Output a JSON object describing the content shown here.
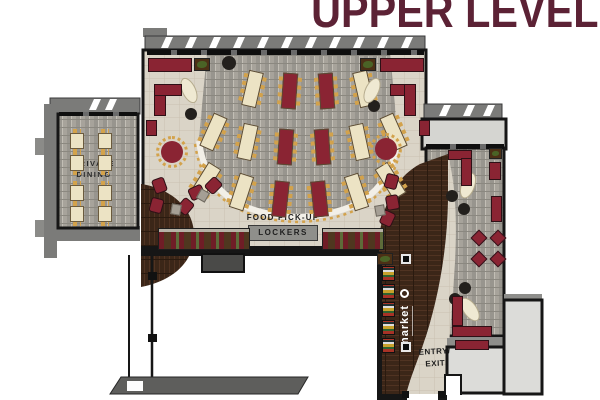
{
  "title": "UPPER LEVEL",
  "labels": {
    "private_dining_line1": "PRIVATE",
    "private_dining_line2": "DINING",
    "food_pickup": "FOOD PICK-UP",
    "lockers": "LOCKERS",
    "market": "market",
    "entry_line1": "ENTRY/",
    "entry_line2": "EXIT"
  },
  "colors": {
    "title": "#5c2235",
    "wall": "#161616",
    "roof": "#7b7b79",
    "canopy": "#d5d5d1",
    "stone": "#d9d3c6",
    "carpet": "#9b9890",
    "wood": "#3a2517",
    "cream": "#ece3c4",
    "table_maroon": "#8a2433",
    "booth_maroon": "#6f1d26",
    "gold": "#d3a24b",
    "locker_gray": "#8f8f8b"
  },
  "furniture": {
    "fan_tables": [
      {
        "x": 253,
        "y": 89,
        "rot": 13,
        "c": "cream"
      },
      {
        "x": 290,
        "y": 91,
        "rot": 4,
        "c": "maroon"
      },
      {
        "x": 327,
        "y": 91,
        "rot": -4,
        "c": "maroon"
      },
      {
        "x": 364,
        "y": 89,
        "rot": -13,
        "c": "cream"
      },
      {
        "x": 214,
        "y": 132,
        "rot": 24,
        "c": "cream"
      },
      {
        "x": 248,
        "y": 142,
        "rot": 12,
        "c": "cream"
      },
      {
        "x": 286,
        "y": 147,
        "rot": 4,
        "c": "maroon"
      },
      {
        "x": 323,
        "y": 147,
        "rot": -4,
        "c": "maroon"
      },
      {
        "x": 360,
        "y": 142,
        "rot": -12,
        "c": "cream"
      },
      {
        "x": 394,
        "y": 132,
        "rot": -24,
        "c": "cream"
      },
      {
        "x": 206,
        "y": 181,
        "rot": 32,
        "c": "cream"
      },
      {
        "x": 242,
        "y": 192,
        "rot": 18,
        "c": "cream"
      },
      {
        "x": 281,
        "y": 199,
        "rot": 6,
        "c": "maroon"
      },
      {
        "x": 320,
        "y": 199,
        "rot": -6,
        "c": "maroon"
      },
      {
        "x": 357,
        "y": 192,
        "rot": -18,
        "c": "cream"
      },
      {
        "x": 391,
        "y": 181,
        "rot": -32,
        "c": "cream"
      }
    ],
    "private_tables": [
      {
        "x": 70,
        "y": 133
      },
      {
        "x": 98,
        "y": 133
      },
      {
        "x": 70,
        "y": 155
      },
      {
        "x": 98,
        "y": 155
      },
      {
        "x": 70,
        "y": 185
      },
      {
        "x": 98,
        "y": 185
      },
      {
        "x": 70,
        "y": 206
      },
      {
        "x": 98,
        "y": 206
      }
    ],
    "columns": [
      {
        "x": 229,
        "y": 63,
        "r": 7
      },
      {
        "x": 191,
        "y": 114,
        "r": 6
      },
      {
        "x": 374,
        "y": 106,
        "r": 6
      },
      {
        "x": 452,
        "y": 196,
        "r": 6
      },
      {
        "x": 464,
        "y": 209,
        "r": 6
      },
      {
        "x": 465,
        "y": 288,
        "r": 6
      },
      {
        "x": 455,
        "y": 299,
        "r": 6
      }
    ],
    "ovals": [
      {
        "x": 189,
        "y": 91,
        "rot": -25
      },
      {
        "x": 372,
        "y": 91,
        "rot": 25
      },
      {
        "x": 468,
        "y": 186,
        "rot": 20
      },
      {
        "x": 470,
        "y": 310,
        "rot": -35
      }
    ],
    "round_tables": [
      {
        "x": 172,
        "y": 152
      },
      {
        "x": 386,
        "y": 149
      }
    ],
    "diamonds": [
      {
        "x": 479,
        "y": 238
      },
      {
        "x": 498,
        "y": 238
      },
      {
        "x": 479,
        "y": 259
      },
      {
        "x": 498,
        "y": 259
      }
    ],
    "lounges": [
      {
        "x": 160,
        "y": 186,
        "rot": -20
      },
      {
        "x": 157,
        "y": 206,
        "rot": 15
      },
      {
        "x": 186,
        "y": 207,
        "rot": 40
      },
      {
        "x": 197,
        "y": 193,
        "rot": 65
      },
      {
        "x": 214,
        "y": 186,
        "rot": 45
      },
      {
        "x": 392,
        "y": 182,
        "rot": 15
      },
      {
        "x": 393,
        "y": 203,
        "rot": -10
      },
      {
        "x": 388,
        "y": 219,
        "rot": 25
      }
    ],
    "side_tables": [
      {
        "x": 176,
        "y": 210,
        "rot": 10
      },
      {
        "x": 380,
        "y": 211,
        "rot": -10
      },
      {
        "x": 203,
        "y": 196,
        "rot": 30
      }
    ],
    "benches": [
      {
        "x": 148,
        "y": 58,
        "w": 44,
        "h": 14,
        "rot": 0
      },
      {
        "x": 380,
        "y": 58,
        "w": 44,
        "h": 14,
        "rot": 0
      },
      {
        "x": 154,
        "y": 84,
        "w": 12,
        "h": 32,
        "rot": 0
      },
      {
        "x": 154,
        "y": 84,
        "w": 28,
        "h": 12,
        "rot": 0
      },
      {
        "x": 390,
        "y": 84,
        "w": 26,
        "h": 12,
        "rot": 0
      },
      {
        "x": 404,
        "y": 84,
        "w": 12,
        "h": 32,
        "rot": 0
      },
      {
        "x": 146,
        "y": 120,
        "w": 11,
        "h": 16,
        "rot": 0
      },
      {
        "x": 419,
        "y": 120,
        "w": 11,
        "h": 16,
        "rot": 0
      },
      {
        "x": 448,
        "y": 150,
        "w": 24,
        "h": 10,
        "rot": 0
      },
      {
        "x": 461,
        "y": 158,
        "w": 11,
        "h": 28,
        "rot": 0
      },
      {
        "x": 489,
        "y": 162,
        "w": 12,
        "h": 18,
        "rot": 0
      },
      {
        "x": 491,
        "y": 196,
        "w": 11,
        "h": 26,
        "rot": 0
      },
      {
        "x": 452,
        "y": 296,
        "w": 11,
        "h": 30,
        "rot": 0
      },
      {
        "x": 452,
        "y": 326,
        "w": 40,
        "h": 11,
        "rot": 0
      },
      {
        "x": 455,
        "y": 340,
        "w": 34,
        "h": 10,
        "rot": 0
      }
    ],
    "booth_rows": [
      {
        "x": 158,
        "y": 228,
        "w": 92,
        "h": 22
      },
      {
        "x": 322,
        "y": 228,
        "w": 62,
        "h": 22
      }
    ],
    "planters": [
      {
        "x": 194,
        "y": 58,
        "w": 16,
        "h": 13
      },
      {
        "x": 360,
        "y": 58,
        "w": 16,
        "h": 13
      },
      {
        "x": 489,
        "y": 148,
        "w": 13,
        "h": 11
      },
      {
        "x": 377,
        "y": 253,
        "w": 16,
        "h": 12
      }
    ],
    "shelves": [
      {
        "x": 382,
        "y": 266
      },
      {
        "x": 382,
        "y": 284
      },
      {
        "x": 382,
        "y": 302
      },
      {
        "x": 382,
        "y": 320
      },
      {
        "x": 382,
        "y": 338
      }
    ],
    "sign_markers": [
      {
        "x": 401,
        "y": 254
      },
      {
        "x": 401,
        "y": 342
      }
    ]
  }
}
